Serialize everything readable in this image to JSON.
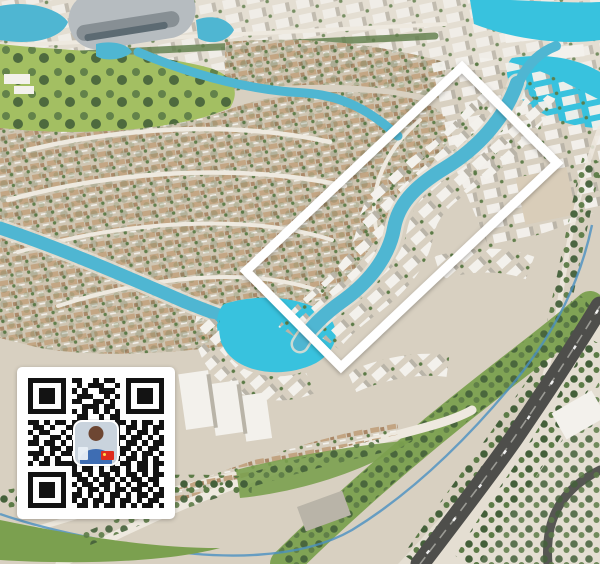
{
  "image": {
    "kind": "aerial-masterplan-render",
    "width": 600,
    "height": 564
  },
  "colors": {
    "sand": "#d8d0c1",
    "sandDeep": "#cfc5b2",
    "sandLight": "#e4ded2",
    "water": "#4fb6d2",
    "waterBright": "#38c2de",
    "streamBlue": "#4a90c2",
    "roadLight": "#eee9df",
    "highway": "#4e4e4b",
    "highwayLine": "#9b9b95",
    "greenLawn": "#a3bf62",
    "greenMid": "#7ba04f",
    "treeMid": "#5c7b47",
    "treeDark": "#44603a",
    "roofTan": "#c2a482",
    "roofBrown": "#a98767",
    "bldgWhite": "#f3f1ec",
    "bldgShade": "#b9b4a8",
    "bldgBeige": "#d9cdb9",
    "stadiumRoof": "#b6bcc0",
    "stadiumSide": "#878f94",
    "glassDark": "#5c6a72",
    "highlight": "#ffffff",
    "qrBg": "#ffffff",
    "qrDark": "#131313",
    "avatarBg": "#c9d3dd",
    "avatarHead": "#6d4632",
    "avatarShirt": "#3e6db3",
    "flagRed": "#de2a1c",
    "flagYellow": "#ffd84d"
  },
  "highlight": {
    "points": "462,67 557,163 341,367 246,271",
    "stroke_width": 9
  },
  "qr": {
    "module_count": 25,
    "rows": [
      "1111111011001011001111111",
      "1000001001011100101000001",
      "1011101010100111001011101",
      "1011101001110010101011101",
      "1011101011001101001011101",
      "1000001000111011001000001",
      "1111111010101010101111111",
      "0000000001100101100000000",
      "1101011011011010110101101",
      "0110100110101100101101011",
      "1011001010110101101011010",
      "0100110101011010110110101",
      "1101101011010110101101011",
      "0010110110101101011010110",
      "1110101101101011010101101",
      "0101010011010110101101010",
      "1011011110101101011011011",
      "0000000010110101101011010",
      "1111111011010110101101011",
      "1000001001101011010110110",
      "1011101010110110101011010",
      "1011101001011010110110101",
      "1011101011010101101011011",
      "1000001010101101011010110",
      "1111111001101011010101101"
    ]
  }
}
